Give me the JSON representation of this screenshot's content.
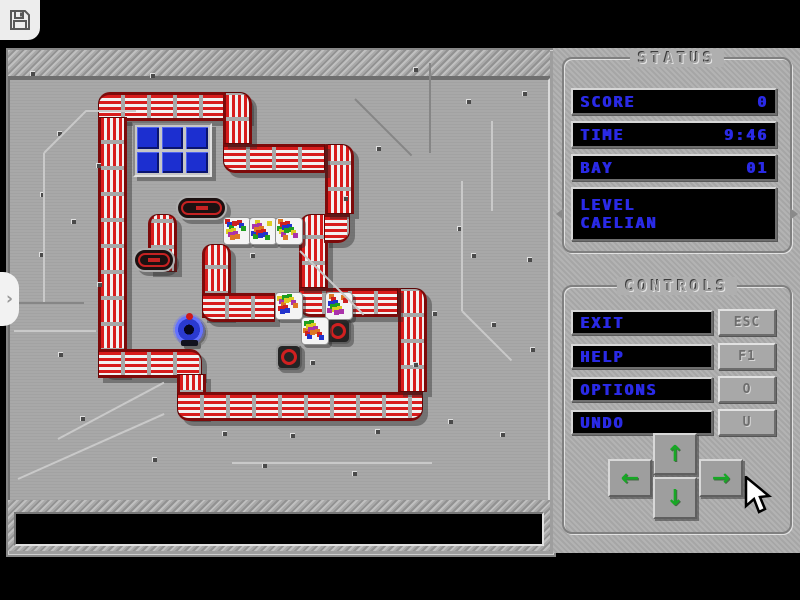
{
  "topbar": {
    "save_icon": "floppy-disk"
  },
  "left_tab": {
    "chevron": "›"
  },
  "status_panel": {
    "title": "STATUS",
    "rows": [
      {
        "label": "SCORE",
        "value": "0"
      },
      {
        "label": "TIME",
        "value": "9:46"
      },
      {
        "label": "BAY",
        "value": "01"
      }
    ],
    "level": {
      "label": "LEVEL",
      "value": "CAELIAN"
    }
  },
  "controls_panel": {
    "title": "CONTROLS",
    "buttons": [
      {
        "label": "EXIT",
        "key": "ESC"
      },
      {
        "label": "HELP",
        "key": "F1"
      },
      {
        "label": "OPTIONS",
        "key": "O"
      },
      {
        "label": "UNDO",
        "key": "U"
      }
    ],
    "dpad": {
      "up": "↑",
      "down": "↓",
      "left": "←",
      "right": "→"
    }
  },
  "colors": {
    "pipe_red": "#d81c1c",
    "pipe_white": "#f2f2f2",
    "pipe_dark_edge": "#7d0a0a",
    "text_blue": "#2a2ae6",
    "arrow_green": "#17a825",
    "window_blue": "#1c2fd0",
    "board_gray": "#a4a4a4",
    "panel_gray": "#afafaf",
    "lcd_black": "#000000"
  },
  "board": {
    "walls": [
      {
        "x": 98,
        "y": 92,
        "w": 151,
        "h": 25,
        "d": "h",
        "r": [
          12,
          12,
          0,
          0
        ]
      },
      {
        "x": 98,
        "y": 117,
        "w": 25,
        "h": 258,
        "d": "v",
        "r": [
          0,
          0,
          0,
          12
        ]
      },
      {
        "x": 98,
        "y": 349,
        "w": 104,
        "h": 25,
        "d": "h",
        "r": [
          0,
          12,
          0,
          0
        ]
      },
      {
        "x": 177,
        "y": 374,
        "w": 25,
        "h": 43,
        "d": "v",
        "r": [
          0,
          0,
          0,
          12
        ]
      },
      {
        "x": 177,
        "y": 392,
        "w": 246,
        "h": 25,
        "d": "h",
        "r": [
          0,
          0,
          12,
          12
        ]
      },
      {
        "x": 398,
        "y": 288,
        "w": 25,
        "h": 104,
        "d": "v",
        "r": [
          0,
          12,
          0,
          0
        ]
      },
      {
        "x": 299,
        "y": 288,
        "w": 99,
        "h": 25,
        "d": "h",
        "r": [
          0,
          0,
          0,
          12
        ]
      },
      {
        "x": 299,
        "y": 214,
        "w": 25,
        "h": 74,
        "d": "v",
        "r": [
          12,
          0,
          0,
          0
        ]
      },
      {
        "x": 324,
        "y": 214,
        "w": 26,
        "h": 25,
        "d": "h",
        "r": [
          0,
          0,
          12,
          0
        ]
      },
      {
        "x": 325,
        "y": 144,
        "w": 25,
        "h": 70,
        "d": "v",
        "r": [
          0,
          12,
          0,
          0
        ]
      },
      {
        "x": 223,
        "y": 144,
        "w": 102,
        "h": 25,
        "d": "h",
        "r": [
          0,
          0,
          0,
          12
        ]
      },
      {
        "x": 223,
        "y": 92,
        "w": 25,
        "h": 52,
        "d": "v",
        "r": [
          0,
          12,
          0,
          0
        ]
      },
      {
        "x": 148,
        "y": 214,
        "w": 25,
        "h": 58,
        "d": "v",
        "r": [
          10,
          10,
          0,
          0
        ]
      },
      {
        "x": 202,
        "y": 244,
        "w": 25,
        "h": 74,
        "d": "v",
        "r": [
          10,
          10,
          0,
          0
        ]
      },
      {
        "x": 202,
        "y": 293,
        "w": 73,
        "h": 25,
        "d": "h",
        "r": [
          0,
          0,
          0,
          12
        ]
      }
    ],
    "pills": [
      {
        "x": 176,
        "y": 196,
        "w": 51,
        "h": 24
      },
      {
        "x": 133,
        "y": 248,
        "w": 42,
        "h": 24
      }
    ],
    "window": {
      "x": 133,
      "y": 123,
      "w": 75,
      "h": 50,
      "cols": 3,
      "rows": 2
    },
    "crates": [
      [
        223,
        217
      ],
      [
        249,
        217
      ],
      [
        275,
        217
      ],
      [
        275,
        292
      ],
      [
        325,
        292
      ],
      [
        301,
        317
      ]
    ],
    "targets": [
      [
        325,
        318
      ],
      [
        276,
        344
      ]
    ],
    "player": {
      "x": 172,
      "y": 312
    },
    "rivets": [
      [
        30,
        71
      ],
      [
        150,
        73
      ],
      [
        413,
        67
      ],
      [
        466,
        99
      ],
      [
        57,
        131
      ],
      [
        40,
        192
      ],
      [
        96,
        163
      ],
      [
        71,
        219
      ],
      [
        39,
        252
      ],
      [
        97,
        282
      ],
      [
        250,
        253
      ],
      [
        343,
        196
      ],
      [
        376,
        146
      ],
      [
        457,
        226
      ],
      [
        471,
        253
      ],
      [
        527,
        257
      ],
      [
        432,
        311
      ],
      [
        491,
        322
      ],
      [
        530,
        347
      ],
      [
        310,
        360
      ],
      [
        413,
        362
      ],
      [
        222,
        431
      ],
      [
        290,
        433
      ],
      [
        375,
        429
      ],
      [
        448,
        419
      ],
      [
        80,
        416
      ],
      [
        152,
        457
      ],
      [
        262,
        463
      ],
      [
        352,
        471
      ],
      [
        500,
        432
      ],
      [
        58,
        352
      ],
      [
        522,
        91
      ]
    ],
    "lines": [
      {
        "x": 44,
        "y": 152,
        "len": 150,
        "rot": 90,
        "c": "light"
      },
      {
        "x": 44,
        "y": 152,
        "len": 60,
        "rot": -45,
        "c": "light"
      },
      {
        "x": 86,
        "y": 110,
        "len": 50,
        "rot": 0,
        "c": "light"
      },
      {
        "x": 14,
        "y": 330,
        "len": 82,
        "rot": 0,
        "c": "light"
      },
      {
        "x": 14,
        "y": 302,
        "len": 70,
        "rot": 0,
        "c": "dark"
      },
      {
        "x": 462,
        "y": 180,
        "len": 130,
        "rot": 90,
        "c": "light"
      },
      {
        "x": 462,
        "y": 310,
        "len": 70,
        "rot": 45,
        "c": "light"
      },
      {
        "x": 355,
        "y": 98,
        "len": 80,
        "rot": 45,
        "c": "dark"
      },
      {
        "x": 430,
        "y": 62,
        "len": 90,
        "rot": 90,
        "c": "dark"
      },
      {
        "x": 58,
        "y": 438,
        "len": 120,
        "rot": -28,
        "c": "light"
      },
      {
        "x": 18,
        "y": 478,
        "len": 160,
        "rot": -24,
        "c": "light"
      },
      {
        "x": 232,
        "y": 462,
        "len": 200,
        "rot": 0,
        "c": "light"
      },
      {
        "x": 300,
        "y": 250,
        "len": 90,
        "rot": 45,
        "c": "light"
      },
      {
        "x": 492,
        "y": 120,
        "len": 90,
        "rot": 90,
        "c": "light"
      }
    ]
  }
}
